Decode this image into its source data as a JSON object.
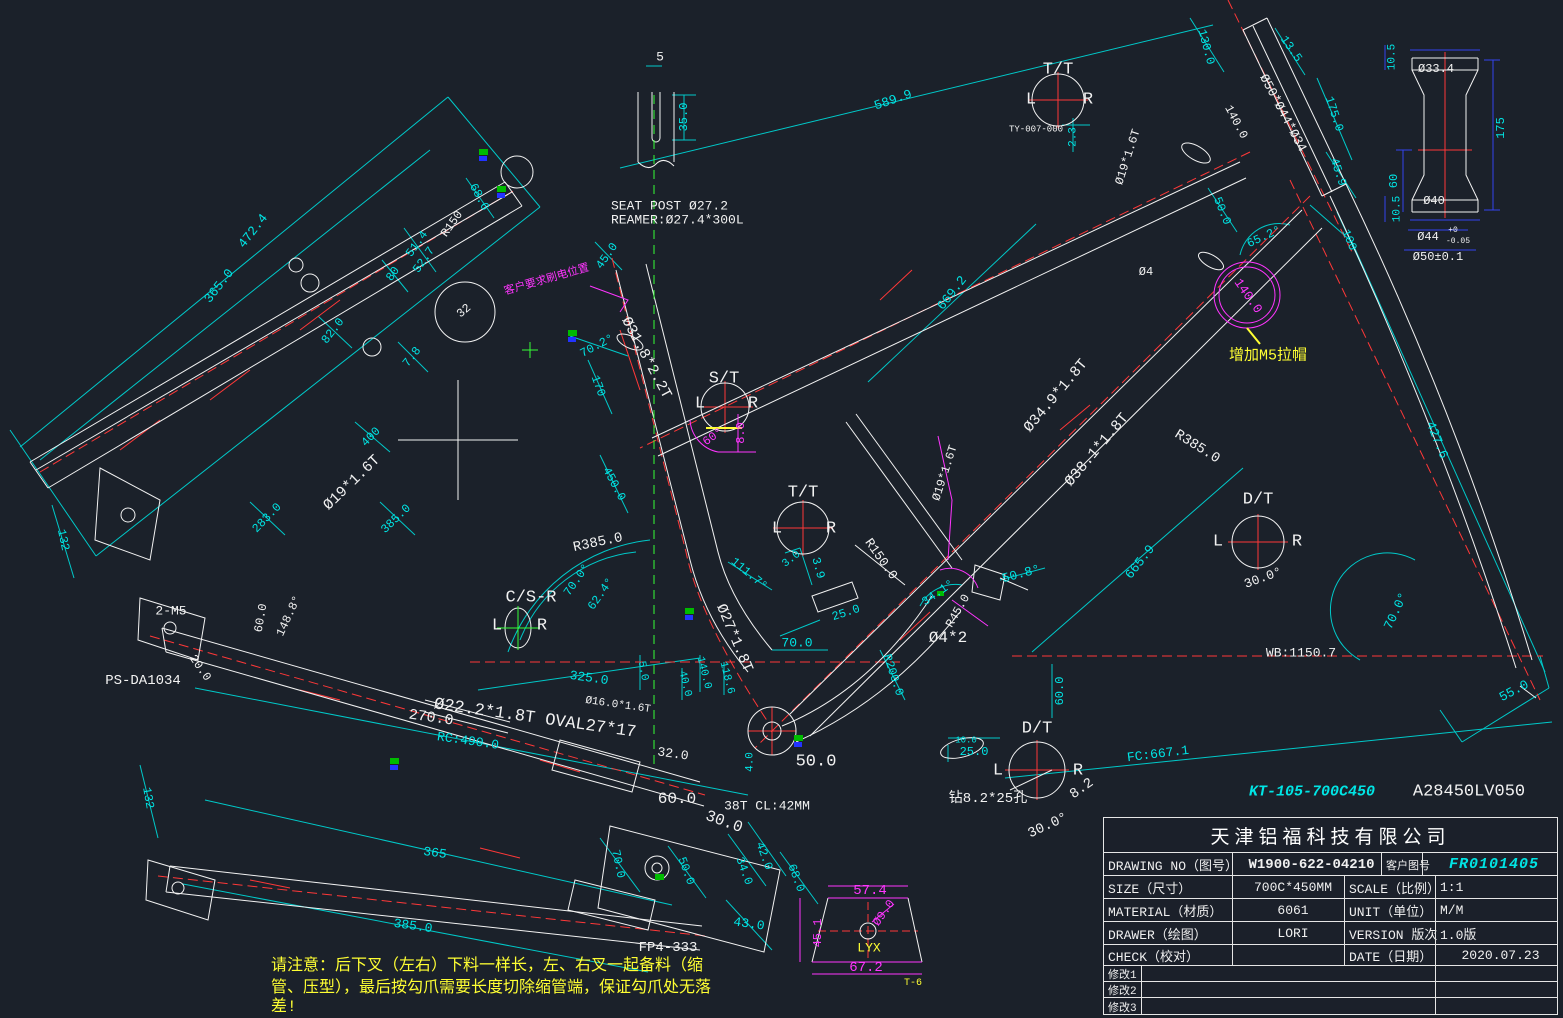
{
  "palette": {
    "w": "#f2f2f2",
    "c": "#00e5e5",
    "y": "#ffff33",
    "m": "#ff35ff",
    "g": "#35ff35",
    "r": "#ff3838"
  },
  "title_block": {
    "company": "天津铝福科技有限公司",
    "drawing_no_label": "DRAWING NO（图号）",
    "drawing_no": "W1900-622-04210",
    "customer_no_label": "客户图号",
    "customer_no": "FR0101405",
    "size_label": "SIZE（尺寸）",
    "size": "700C*450MM",
    "scale_label": "SCALE（比例）",
    "scale": "1:1",
    "material_label": "MATERIAL（材质）",
    "material": "6061",
    "unit_label": "UNIT（单位）",
    "unit": "M/M",
    "drawer_label": "DRAWER（绘图）",
    "drawer": "LORI",
    "version_label": "VERSION 版次",
    "version": "1.0版",
    "check_label": "CHECK（校对）",
    "check": "",
    "date_label": "DATE（日期）",
    "date": "2020.07.23",
    "rev1": "修改1",
    "rev2": "修改2",
    "rev3": "修改3"
  },
  "annotations": [
    {
      "t": "472.4",
      "x": 253,
      "y": 231,
      "r": -52,
      "c": "c",
      "s": 13
    },
    {
      "t": "365.0",
      "x": 219,
      "y": 286,
      "r": -52,
      "c": "c",
      "s": 13
    },
    {
      "t": "68.6",
      "x": 479,
      "y": 197,
      "r": 62,
      "c": "c"
    },
    {
      "t": "R150",
      "x": 452,
      "y": 224,
      "r": -55,
      "c": "w"
    },
    {
      "t": "51.4",
      "x": 417,
      "y": 244,
      "r": -55,
      "c": "c"
    },
    {
      "t": "52.7",
      "x": 424,
      "y": 260,
      "r": -55,
      "c": "c"
    },
    {
      "t": "80",
      "x": 393,
      "y": 274,
      "r": -55,
      "c": "c"
    },
    {
      "t": "82.0",
      "x": 333,
      "y": 331,
      "r": -52,
      "c": "c"
    },
    {
      "t": "32",
      "x": 464,
      "y": 311,
      "r": -40,
      "c": "w"
    },
    {
      "t": "7.8",
      "x": 412,
      "y": 357,
      "r": -52,
      "c": "c"
    },
    {
      "t": "132",
      "x": 63,
      "y": 540,
      "r": 78,
      "c": "c"
    },
    {
      "t": "400",
      "x": 371,
      "y": 437,
      "r": -46,
      "c": "c"
    },
    {
      "t": "283.0",
      "x": 267,
      "y": 518,
      "r": -46,
      "c": "c"
    },
    {
      "t": "Ø19*1.6T",
      "x": 352,
      "y": 483,
      "r": -44,
      "c": "w",
      "s": 15
    },
    {
      "t": "385.0",
      "x": 396,
      "y": 519,
      "r": -44,
      "c": "c"
    },
    {
      "t": "2-M5",
      "x": 171,
      "y": 611,
      "c": "w",
      "s": 13
    },
    {
      "t": "60.0",
      "x": 261,
      "y": 618,
      "r": -80,
      "c": "w"
    },
    {
      "t": "148.8°",
      "x": 289,
      "y": 616,
      "r": -65,
      "c": "w"
    },
    {
      "t": "20.0",
      "x": 200,
      "y": 668,
      "r": 55,
      "c": "w"
    },
    {
      "t": "PS-DA1034",
      "x": 143,
      "y": 681,
      "c": "w",
      "s": 14
    },
    {
      "t": "客户要求刷电位置",
      "x": 547,
      "y": 281,
      "r": -16,
      "c": "m",
      "s": 11
    },
    {
      "t": "5",
      "x": 660,
      "y": 57,
      "c": "w",
      "s": 13
    },
    {
      "t": "35.0",
      "x": 684,
      "y": 117,
      "r": -90,
      "c": "c"
    },
    {
      "t": "SEAT POST Ø27.2",
      "x": 611,
      "y": 206,
      "c": "w",
      "s": 13,
      "a": "l"
    },
    {
      "t": "REAMER:Ø27.4*300L",
      "x": 611,
      "y": 220,
      "c": "w",
      "s": 13,
      "a": "l"
    },
    {
      "t": "589.9",
      "x": 893,
      "y": 100,
      "r": -19,
      "c": "c",
      "s": 13
    },
    {
      "t": "T/T",
      "x": 1058,
      "y": 70,
      "c": "w",
      "s": 17
    },
    {
      "t": "L",
      "x": 1031,
      "y": 100,
      "c": "w",
      "s": 17
    },
    {
      "t": "R",
      "x": 1088,
      "y": 100,
      "c": "w",
      "s": 17
    },
    {
      "t": "TY-007-000",
      "x": 1036,
      "y": 130,
      "c": "w",
      "s": 9
    },
    {
      "t": "2.3",
      "x": 1074,
      "y": 137,
      "r": -90,
      "c": "c",
      "s": 11
    },
    {
      "t": "130.0",
      "x": 1206,
      "y": 47,
      "r": 75,
      "c": "c"
    },
    {
      "t": "13.5",
      "x": 1291,
      "y": 49,
      "r": 55,
      "c": "c"
    },
    {
      "t": "Ø50*Ø44*Ø34",
      "x": 1283,
      "y": 113,
      "r": 62,
      "c": "w",
      "s": 13
    },
    {
      "t": "140.0",
      "x": 1236,
      "y": 122,
      "r": 62,
      "c": "w"
    },
    {
      "t": "Ø19*1.6T",
      "x": 1128,
      "y": 157,
      "r": -72,
      "c": "w"
    },
    {
      "t": "175.0",
      "x": 1334,
      "y": 114,
      "r": 72,
      "c": "c"
    },
    {
      "t": "45.9",
      "x": 1338,
      "y": 172,
      "r": 72,
      "c": "c"
    },
    {
      "t": "50.0",
      "x": 1222,
      "y": 211,
      "r": 68,
      "c": "c"
    },
    {
      "t": "65.2°",
      "x": 1264,
      "y": 237,
      "r": -25,
      "c": "c"
    },
    {
      "t": "100",
      "x": 1349,
      "y": 240,
      "r": 68,
      "c": "c"
    },
    {
      "t": "Ø4",
      "x": 1146,
      "y": 272,
      "c": "w"
    },
    {
      "t": "140.0",
      "x": 1248,
      "y": 296,
      "r": 55,
      "c": "m",
      "s": 13
    },
    {
      "t": "增加M5拉帽",
      "x": 1268,
      "y": 356,
      "c": "y",
      "s": 15
    },
    {
      "t": "427.6",
      "x": 1437,
      "y": 440,
      "r": 68,
      "c": "c",
      "s": 13
    },
    {
      "t": "R385.0",
      "x": 1197,
      "y": 447,
      "r": 32,
      "c": "w",
      "s": 14
    },
    {
      "t": "D/T",
      "x": 1258,
      "y": 500,
      "c": "w",
      "s": 17
    },
    {
      "t": "L",
      "x": 1218,
      "y": 542,
      "c": "w",
      "s": 17
    },
    {
      "t": "R",
      "x": 1297,
      "y": 542,
      "c": "w",
      "s": 17
    },
    {
      "t": "30.0°",
      "x": 1263,
      "y": 578,
      "r": -20,
      "c": "w",
      "s": 13
    },
    {
      "t": "665.9",
      "x": 1140,
      "y": 562,
      "r": -52,
      "c": "c",
      "s": 13
    },
    {
      "t": "70.0°",
      "x": 1396,
      "y": 611,
      "r": -65,
      "c": "c",
      "s": 13
    },
    {
      "t": "WB:1150.7",
      "x": 1301,
      "y": 653,
      "c": "w",
      "s": 13
    },
    {
      "t": "55.0",
      "x": 1514,
      "y": 691,
      "r": -28,
      "c": "c",
      "s": 13
    },
    {
      "t": "FC:667.1",
      "x": 1158,
      "y": 754,
      "r": -7,
      "c": "c",
      "s": 13
    },
    {
      "t": "KT-105-700C450",
      "x": 1312,
      "y": 792,
      "c": "c",
      "s": 15,
      "st": "bi",
      "n": "customer-model-code"
    },
    {
      "t": "A28450LV050",
      "x": 1469,
      "y": 792,
      "c": "w",
      "s": 17,
      "n": "part-code"
    },
    {
      "t": "669.2",
      "x": 952,
      "y": 293,
      "r": -52,
      "c": "c",
      "s": 13
    },
    {
      "t": "Ø34.9*1.8T",
      "x": 1056,
      "y": 396,
      "r": -50,
      "c": "w",
      "s": 15
    },
    {
      "t": "Ø38.1*1.8T",
      "x": 1097,
      "y": 450,
      "r": -50,
      "c": "w",
      "s": 15
    },
    {
      "t": "Ø19*1.6T",
      "x": 945,
      "y": 473,
      "r": -72,
      "c": "w"
    },
    {
      "t": "R150.0",
      "x": 881,
      "y": 559,
      "r": 55,
      "c": "w",
      "s": 13
    },
    {
      "t": "34.1°",
      "x": 938,
      "y": 593,
      "r": -35,
      "c": "c"
    },
    {
      "t": "R45.0",
      "x": 958,
      "y": 611,
      "r": -60,
      "c": "w"
    },
    {
      "t": "50.8°",
      "x": 1021,
      "y": 574,
      "r": -15,
      "c": "c",
      "s": 13
    },
    {
      "t": "Ø4*2",
      "x": 948,
      "y": 638,
      "c": "w",
      "s": 16
    },
    {
      "t": "25.0",
      "x": 846,
      "y": 613,
      "r": -18,
      "c": "c"
    },
    {
      "t": "70.0",
      "x": 797,
      "y": 643,
      "c": "c",
      "s": 13
    },
    {
      "t": "R200.0",
      "x": 893,
      "y": 675,
      "r": 72,
      "c": "c"
    },
    {
      "t": "T/T",
      "x": 803,
      "y": 493,
      "c": "w",
      "s": 17
    },
    {
      "t": "L",
      "x": 777,
      "y": 529,
      "c": "w",
      "s": 17
    },
    {
      "t": "R",
      "x": 831,
      "y": 529,
      "c": "w",
      "s": 17
    },
    {
      "t": "3.0",
      "x": 792,
      "y": 560,
      "r": -38,
      "c": "c",
      "s": 11
    },
    {
      "t": "3.9",
      "x": 818,
      "y": 568,
      "r": 75,
      "c": "c"
    },
    {
      "t": "111.7°",
      "x": 749,
      "y": 574,
      "r": 40,
      "c": "c"
    },
    {
      "t": "Ø27*1.8T",
      "x": 734,
      "y": 638,
      "r": 67,
      "c": "w",
      "s": 15
    },
    {
      "t": "140.0",
      "x": 703,
      "y": 673,
      "r": 76,
      "c": "c",
      "s": 11
    },
    {
      "t": "118.6",
      "x": 726,
      "y": 678,
      "r": 76,
      "c": "c",
      "s": 11
    },
    {
      "t": "40.0",
      "x": 684,
      "y": 684,
      "r": 76,
      "c": "c",
      "s": 11
    },
    {
      "t": "5.0",
      "x": 642,
      "y": 671,
      "r": 80,
      "c": "c",
      "s": 11
    },
    {
      "t": "325.0",
      "x": 589,
      "y": 678,
      "r": 8,
      "c": "c",
      "s": 13
    },
    {
      "t": "R385.0",
      "x": 598,
      "y": 543,
      "r": -12,
      "c": "w",
      "s": 14
    },
    {
      "t": "C/S-R",
      "x": 531,
      "y": 598,
      "c": "w",
      "s": 17
    },
    {
      "t": "L",
      "x": 497,
      "y": 626,
      "c": "w",
      "s": 17
    },
    {
      "t": "R",
      "x": 542,
      "y": 626,
      "c": "w",
      "s": 17
    },
    {
      "t": "70.0°",
      "x": 577,
      "y": 580,
      "r": -55,
      "c": "c"
    },
    {
      "t": "62.4°",
      "x": 601,
      "y": 594,
      "r": -55,
      "c": "c"
    },
    {
      "t": "170",
      "x": 598,
      "y": 386,
      "r": 70,
      "c": "c"
    },
    {
      "t": "70.2°",
      "x": 597,
      "y": 346,
      "r": -28,
      "c": "c"
    },
    {
      "t": "Ø31.8*2.2T",
      "x": 646,
      "y": 358,
      "r": 62,
      "c": "w",
      "s": 15
    },
    {
      "t": "S/T",
      "x": 724,
      "y": 379,
      "c": "w",
      "s": 17
    },
    {
      "t": "L",
      "x": 700,
      "y": 404,
      "c": "w",
      "s": 17
    },
    {
      "t": "R",
      "x": 753,
      "y": 404,
      "c": "w",
      "s": 17
    },
    {
      "t": "60°",
      "x": 713,
      "y": 437,
      "r": -35,
      "c": "m"
    },
    {
      "t": "8.0",
      "x": 741,
      "y": 433,
      "r": -90,
      "c": "m"
    },
    {
      "t": "45.0",
      "x": 607,
      "y": 256,
      "r": -55,
      "c": "c"
    },
    {
      "t": "450.0",
      "x": 614,
      "y": 484,
      "r": 62,
      "c": "c"
    },
    {
      "t": "Ø16.0*1.6T",
      "x": 618,
      "y": 706,
      "r": 8,
      "c": "w",
      "s": 11
    },
    {
      "t": "Ø22.2*1.8T OVAL27*17",
      "x": 535,
      "y": 719,
      "r": 8,
      "c": "w",
      "s": 17
    },
    {
      "t": "270.0",
      "x": 431,
      "y": 718,
      "r": 8,
      "c": "w",
      "s": 15
    },
    {
      "t": "RC:490.0",
      "x": 468,
      "y": 741,
      "r": 8,
      "c": "c",
      "s": 13
    },
    {
      "t": "32.0",
      "x": 673,
      "y": 754,
      "r": 8,
      "c": "w",
      "s": 13
    },
    {
      "t": "4.0",
      "x": 751,
      "y": 762,
      "r": -90,
      "c": "c",
      "s": 11
    },
    {
      "t": "50.0",
      "x": 816,
      "y": 762,
      "c": "w",
      "s": 17
    },
    {
      "t": "60.0",
      "x": 677,
      "y": 799,
      "c": "w",
      "s": 16
    },
    {
      "t": "38T CL:42MM",
      "x": 767,
      "y": 806,
      "c": "w",
      "s": 13
    },
    {
      "t": "30.0",
      "x": 724,
      "y": 822,
      "r": 20,
      "c": "w",
      "s": 16
    },
    {
      "t": "70.0",
      "x": 618,
      "y": 864,
      "r": 78,
      "c": "c"
    },
    {
      "t": "50.0",
      "x": 686,
      "y": 871,
      "r": 70,
      "c": "c"
    },
    {
      "t": "34.0",
      "x": 744,
      "y": 871,
      "r": 70,
      "c": "c"
    },
    {
      "t": "42.0",
      "x": 764,
      "y": 856,
      "r": 70,
      "c": "c"
    },
    {
      "t": "68.0",
      "x": 796,
      "y": 878,
      "r": 70,
      "c": "c"
    },
    {
      "t": "43.0",
      "x": 749,
      "y": 924,
      "r": 8,
      "c": "c",
      "s": 13
    },
    {
      "t": "FP4-333",
      "x": 668,
      "y": 948,
      "c": "w",
      "s": 14
    },
    {
      "t": "132",
      "x": 148,
      "y": 798,
      "r": 80,
      "c": "c"
    },
    {
      "t": "365",
      "x": 435,
      "y": 853,
      "r": 8,
      "c": "c",
      "s": 13
    },
    {
      "t": "385.0",
      "x": 413,
      "y": 926,
      "r": 8,
      "c": "c",
      "s": 13
    },
    {
      "t": "60.0",
      "x": 1060,
      "y": 691,
      "r": -90,
      "c": "c"
    },
    {
      "t": "D/T",
      "x": 1037,
      "y": 729,
      "c": "w",
      "s": 17
    },
    {
      "t": "L",
      "x": 998,
      "y": 771,
      "c": "w",
      "s": 17
    },
    {
      "t": "R",
      "x": 1078,
      "y": 771,
      "c": "w",
      "s": 17
    },
    {
      "t": "10.0",
      "x": 966,
      "y": 741,
      "c": "c",
      "s": 9
    },
    {
      "t": "25.0",
      "x": 974,
      "y": 752,
      "c": "c"
    },
    {
      "t": "钻8.2*25孔",
      "x": 988,
      "y": 799,
      "c": "w",
      "s": 14
    },
    {
      "t": "8.2",
      "x": 1082,
      "y": 789,
      "r": -35,
      "c": "w",
      "s": 14
    },
    {
      "t": "30.0°",
      "x": 1048,
      "y": 826,
      "r": -25,
      "c": "w",
      "s": 14
    },
    {
      "t": "10.5",
      "x": 1393,
      "y": 57,
      "r": -90,
      "c": "c",
      "s": 11
    },
    {
      "t": "Ø33.4",
      "x": 1436,
      "y": 69,
      "c": "w"
    },
    {
      "t": "175",
      "x": 1501,
      "y": 128,
      "r": -90,
      "c": "c"
    },
    {
      "t": "60",
      "x": 1394,
      "y": 181,
      "r": -90,
      "c": "c"
    },
    {
      "t": "10.5",
      "x": 1398,
      "y": 209,
      "r": -90,
      "c": "c",
      "s": 11
    },
    {
      "t": "Ø40",
      "x": 1434,
      "y": 201,
      "c": "w"
    },
    {
      "t": "Ø44",
      "x": 1428,
      "y": 237,
      "c": "w"
    },
    {
      "t": "+0",
      "x": 1453,
      "y": 231,
      "c": "w",
      "s": 8
    },
    {
      "t": "-0.05",
      "x": 1458,
      "y": 242,
      "c": "w",
      "s": 8
    },
    {
      "t": "Ø50±0.1",
      "x": 1438,
      "y": 257,
      "c": "w"
    },
    {
      "t": "57.4",
      "x": 870,
      "y": 891,
      "c": "m",
      "s": 14
    },
    {
      "t": "Ø9.0",
      "x": 884,
      "y": 913,
      "r": -55,
      "c": "m"
    },
    {
      "t": "45.1",
      "x": 818,
      "y": 933,
      "r": -90,
      "c": "m"
    },
    {
      "t": "LYX",
      "x": 869,
      "y": 948,
      "c": "y",
      "s": 13
    },
    {
      "t": "67.2",
      "x": 866,
      "y": 968,
      "c": "m",
      "s": 14
    },
    {
      "t": "T-6",
      "x": 913,
      "y": 984,
      "c": "y",
      "s": 10
    },
    {
      "t": "请注意：后下叉（左右）下料一样长，左、右叉一起备料（缩",
      "x": 271,
      "y": 966,
      "c": "y",
      "s": 16,
      "a": "l",
      "n": "note-line"
    },
    {
      "t": "管、压型），最后按勾爪需要长度切除缩管端，保证勾爪处无落",
      "x": 271,
      "y": 988,
      "c": "y",
      "s": 16,
      "a": "l",
      "n": "note-line"
    },
    {
      "t": "差!",
      "x": 271,
      "y": 1007,
      "c": "y",
      "s": 16,
      "a": "l",
      "n": "note-line"
    }
  ]
}
